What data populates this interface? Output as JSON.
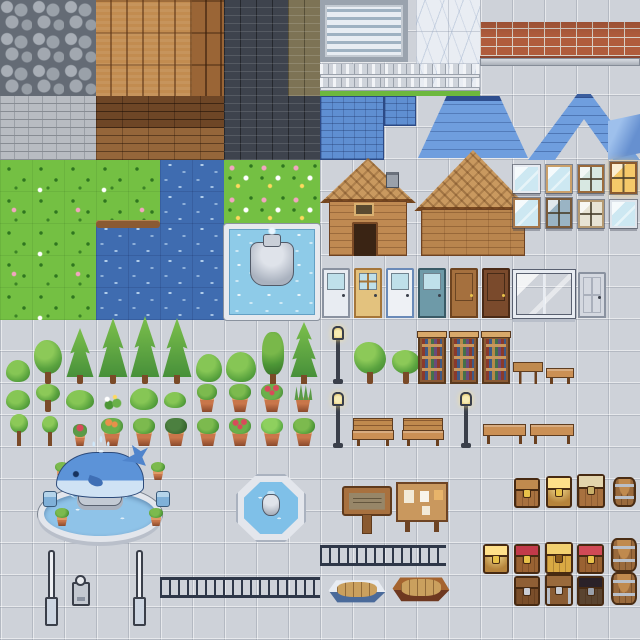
{
  "sheet": {
    "description": "pixel-art town tileset sprite sheet",
    "tile_size_px": 32,
    "grid": "20x20 tiles",
    "canvas": "640x640"
  },
  "palette": {
    "floor_tile": "#ced2d9",
    "grass": "#74c043",
    "water": "#3f6cb0",
    "pool_water": "#8ecbe8",
    "roof_blue": "#5f8fd2",
    "wood_plank": "#c28c50",
    "brick_red": "#b05c3c",
    "brick_dark": "#3e434d",
    "stone_brick": "#b8bcc2",
    "marble": "#e9edf3",
    "whale_blue": "#5c93d8",
    "chest_gold": "#e8c24a",
    "terracotta": "#c9764a",
    "barrel_wood": "#9a6a3c"
  },
  "sections": {
    "top_left": "cobblestone, wood plank floors, brick walls, stone walls, grass, river and lake water, swimming pool with fountain",
    "top_right": "blinds window, marble wall, red brick ledge, picket fence, blue roofs, wooden cabins, windows, doors",
    "middle": "trees, bushes, potted plants, lamp posts, bookshelves, benches, tables",
    "bottom": "whale fountain, octagon fountain, wooden sign, notice board, railings, boats, treasure chests, barrels, posts"
  },
  "sprites": [
    {
      "name": "cobblestone-floor",
      "kind": "cobble",
      "x": 0,
      "y": 0,
      "w": 96,
      "h": 96
    },
    {
      "name": "wood-plank-floor-light",
      "kind": "wood-v",
      "x": 96,
      "y": 0,
      "w": 96,
      "h": 96
    },
    {
      "name": "wood-plank-floor-dark",
      "kind": "wood-v-dark",
      "x": 192,
      "y": 0,
      "w": 32,
      "h": 96
    },
    {
      "name": "brick-wall-dark",
      "kind": "brick-dark",
      "x": 224,
      "y": 0,
      "w": 64,
      "h": 160
    },
    {
      "name": "brick-wall-olive",
      "kind": "brick-olive",
      "x": 288,
      "y": 0,
      "w": 32,
      "h": 96
    },
    {
      "name": "brick-wall-dark-2",
      "kind": "brick-dark",
      "x": 288,
      "y": 96,
      "w": 32,
      "h": 64
    },
    {
      "name": "stone-brick-wall",
      "kind": "brick-gray",
      "x": 0,
      "y": 96,
      "w": 96,
      "h": 64
    },
    {
      "name": "wood-planks-horizontal-dark",
      "kind": "wood-h-dark",
      "x": 96,
      "y": 96,
      "w": 128,
      "h": 32
    },
    {
      "name": "wood-planks-horizontal",
      "kind": "wood-h",
      "x": 96,
      "y": 128,
      "w": 128,
      "h": 32
    },
    {
      "name": "grass-field",
      "kind": "grass",
      "x": 0,
      "y": 160,
      "w": 160,
      "h": 64
    },
    {
      "name": "river-water",
      "kind": "water",
      "x": 160,
      "y": 160,
      "w": 64,
      "h": 64
    },
    {
      "name": "grass-flower-field",
      "kind": "grass-flowers",
      "x": 224,
      "y": 160,
      "w": 96,
      "h": 64
    },
    {
      "name": "grass-field-2",
      "kind": "grass",
      "x": 0,
      "y": 224,
      "w": 96,
      "h": 96
    },
    {
      "name": "lake-water",
      "kind": "water",
      "x": 96,
      "y": 224,
      "w": 128,
      "h": 96
    },
    {
      "name": "shore-edge",
      "kind": "shore",
      "x": 96,
      "y": 220,
      "w": 64,
      "h": 8
    },
    {
      "name": "swimming-pool",
      "kind": "pool",
      "x": 224,
      "y": 224,
      "w": 96,
      "h": 96
    },
    {
      "name": "pool-fountain",
      "kind": "pool-fountain",
      "x": 250,
      "y": 242,
      "w": 44,
      "h": 44
    },
    {
      "name": "window-blinds",
      "kind": "blinds",
      "x": 320,
      "y": 0,
      "w": 88,
      "h": 62
    },
    {
      "name": "marble-wall",
      "kind": "marble",
      "x": 416,
      "y": 0,
      "w": 64,
      "h": 96
    },
    {
      "name": "red-brick-ledge",
      "kind": "brick-red",
      "x": 480,
      "y": 22,
      "w": 160,
      "h": 36
    },
    {
      "name": "stone-ledge",
      "kind": "ledge",
      "x": 480,
      "y": 58,
      "w": 160,
      "h": 8
    },
    {
      "name": "picket-fence",
      "kind": "fence",
      "x": 320,
      "y": 64,
      "w": 160,
      "h": 32
    },
    {
      "name": "blue-roof-flat",
      "kind": "roof-flat",
      "x": 320,
      "y": 96,
      "w": 64,
      "h": 64
    },
    {
      "name": "blue-roof-tile",
      "kind": "roof-flat",
      "x": 384,
      "y": 96,
      "w": 32,
      "h": 30
    },
    {
      "name": "blue-roof-hip",
      "kind": "roof-hip",
      "x": 418,
      "y": 96,
      "w": 110,
      "h": 62
    },
    {
      "name": "blue-roof-gable",
      "kind": "roof-chevron",
      "x": 528,
      "y": 94,
      "w": 112,
      "h": 66
    },
    {
      "name": "blue-glass-corner",
      "kind": "glass-corner",
      "x": 608,
      "y": 114,
      "w": 32,
      "h": 46
    },
    {
      "name": "cabin-house",
      "kind": "house-a",
      "x": 320,
      "y": 158,
      "w": 96,
      "h": 98
    },
    {
      "name": "barn-house",
      "kind": "house-b",
      "x": 414,
      "y": 150,
      "w": 118,
      "h": 106
    },
    {
      "name": "cabin-chimney",
      "kind": "chimney",
      "x": 386,
      "y": 172,
      "w": 13,
      "h": 16
    },
    {
      "name": "cabin-window",
      "kind": "window-small",
      "x": 354,
      "y": 203,
      "w": 20,
      "h": 13
    },
    {
      "name": "cabin-doorway",
      "kind": "doorway",
      "x": 352,
      "y": 222,
      "w": 26,
      "h": 34
    },
    {
      "name": "window-white",
      "kind": "win win-white",
      "x": 513,
      "y": 165,
      "w": 27,
      "h": 28
    },
    {
      "name": "window-glass",
      "kind": "win win-glass",
      "x": 546,
      "y": 165,
      "w": 26,
      "h": 28
    },
    {
      "name": "window-brown-4pane",
      "kind": "win cross win-brown",
      "x": 578,
      "y": 165,
      "w": 26,
      "h": 28
    },
    {
      "name": "window-lit",
      "kind": "win cross win-lit",
      "x": 610,
      "y": 162,
      "w": 27,
      "h": 32
    },
    {
      "name": "window-wood-2pane",
      "kind": "win win-wood2",
      "x": 513,
      "y": 198,
      "w": 27,
      "h": 30
    },
    {
      "name": "window-dark-4pane",
      "kind": "win cross win-dark4",
      "x": 546,
      "y": 198,
      "w": 26,
      "h": 30
    },
    {
      "name": "window-cream",
      "kind": "win cross win-cream",
      "x": 578,
      "y": 200,
      "w": 26,
      "h": 28
    },
    {
      "name": "window-white-2",
      "kind": "win win-white2",
      "x": 610,
      "y": 200,
      "w": 27,
      "h": 28
    },
    {
      "name": "door-white-glass",
      "kind": "door door-whiteglass",
      "x": 322,
      "y": 268,
      "w": 28,
      "h": 50
    },
    {
      "name": "door-tan",
      "kind": "door door-tan",
      "x": 354,
      "y": 268,
      "w": 28,
      "h": 50
    },
    {
      "name": "door-white-blue",
      "kind": "door door-whiteblue",
      "x": 386,
      "y": 268,
      "w": 28,
      "h": 50
    },
    {
      "name": "door-teal-glass",
      "kind": "door door-teal",
      "x": 418,
      "y": 268,
      "w": 28,
      "h": 50
    },
    {
      "name": "door-brown",
      "kind": "door door-brown",
      "x": 450,
      "y": 268,
      "w": 28,
      "h": 50
    },
    {
      "name": "door-dark-brown",
      "kind": "door door-dark",
      "x": 482,
      "y": 268,
      "w": 28,
      "h": 50
    },
    {
      "name": "storefront-window",
      "kind": "big-window",
      "x": 513,
      "y": 270,
      "w": 62,
      "h": 48
    },
    {
      "name": "door-gray-panel",
      "kind": "door door-gray",
      "x": 578,
      "y": 272,
      "w": 28,
      "h": 46
    },
    {
      "name": "bush-small",
      "kind": "bush",
      "x": 6,
      "y": 360,
      "w": 24,
      "h": 22
    },
    {
      "name": "tree-round-medium",
      "kind": "tree-round",
      "x": 34,
      "y": 340,
      "w": 28,
      "h": 44
    },
    {
      "name": "tree-conifer",
      "kind": "tree-conifer",
      "x": 66,
      "y": 328,
      "w": 28,
      "h": 56
    },
    {
      "name": "tree-conifer-tall-1",
      "kind": "tree-conifer",
      "x": 98,
      "y": 318,
      "w": 30,
      "h": 66
    },
    {
      "name": "tree-conifer-tall-2",
      "kind": "tree-conifer",
      "x": 130,
      "y": 316,
      "w": 30,
      "h": 68
    },
    {
      "name": "tree-conifer-tall-3",
      "kind": "tree-conifer",
      "x": 162,
      "y": 318,
      "w": 30,
      "h": 66
    },
    {
      "name": "bush-medium",
      "kind": "bush",
      "x": 196,
      "y": 354,
      "w": 26,
      "h": 28
    },
    {
      "name": "bush-wide",
      "kind": "bush",
      "x": 226,
      "y": 352,
      "w": 30,
      "h": 30
    },
    {
      "name": "tree-slim",
      "kind": "tree-slim",
      "x": 260,
      "y": 332,
      "w": 26,
      "h": 52
    },
    {
      "name": "tree-pine-double",
      "kind": "tree-pine2",
      "x": 290,
      "y": 322,
      "w": 28,
      "h": 62
    },
    {
      "name": "lamp-post-1",
      "kind": "lamp",
      "x": 331,
      "y": 326,
      "w": 14,
      "h": 58
    },
    {
      "name": "tree-round-leafy-1",
      "kind": "tree-round",
      "x": 354,
      "y": 342,
      "w": 32,
      "h": 42
    },
    {
      "name": "tree-round-leafy-2",
      "kind": "tree-round",
      "x": 392,
      "y": 350,
      "w": 28,
      "h": 34
    },
    {
      "name": "bookshelf-1",
      "kind": "bookshelf",
      "x": 418,
      "y": 334,
      "w": 28,
      "h": 50
    },
    {
      "name": "bookshelf-2",
      "kind": "bookshelf",
      "x": 450,
      "y": 334,
      "w": 28,
      "h": 50
    },
    {
      "name": "bookshelf-3",
      "kind": "bookshelf",
      "x": 482,
      "y": 334,
      "w": 28,
      "h": 50
    },
    {
      "name": "table",
      "kind": "table",
      "x": 513,
      "y": 362,
      "w": 30,
      "h": 22
    },
    {
      "name": "bench-low",
      "kind": "bench-backless",
      "x": 546,
      "y": 368,
      "w": 28,
      "h": 16
    },
    {
      "name": "bush-dome-1",
      "kind": "bush",
      "x": 6,
      "y": 390,
      "w": 24,
      "h": 20
    },
    {
      "name": "tree-round-small",
      "kind": "tree-round",
      "x": 36,
      "y": 384,
      "w": 24,
      "h": 28
    },
    {
      "name": "bush-wide-2",
      "kind": "bush",
      "x": 66,
      "y": 390,
      "w": 28,
      "h": 20
    },
    {
      "name": "flower-sprigs",
      "kind": "flowers",
      "x": 100,
      "y": 392,
      "w": 24,
      "h": 18
    },
    {
      "name": "bush-dense",
      "kind": "bush",
      "x": 130,
      "y": 388,
      "w": 28,
      "h": 22
    },
    {
      "name": "bush-dome-2",
      "kind": "bush",
      "x": 164,
      "y": 392,
      "w": 22,
      "h": 16
    },
    {
      "name": "potted-plant-1",
      "kind": "pot pot-leafy",
      "x": 196,
      "y": 384,
      "w": 22,
      "h": 28
    },
    {
      "name": "potted-plant-2",
      "kind": "pot pot-leafy",
      "x": 228,
      "y": 384,
      "w": 24,
      "h": 28
    },
    {
      "name": "potted-plant-red",
      "kind": "pot pot-red",
      "x": 260,
      "y": 384,
      "w": 24,
      "h": 28
    },
    {
      "name": "potted-plant-spiky",
      "kind": "pot pot-spiky",
      "x": 292,
      "y": 384,
      "w": 22,
      "h": 28
    },
    {
      "name": "tree-lollipop-1",
      "kind": "tree-lollipop",
      "x": 8,
      "y": 414,
      "w": 22,
      "h": 32
    },
    {
      "name": "tree-lollipop-2",
      "kind": "tree-lollipop",
      "x": 40,
      "y": 416,
      "w": 20,
      "h": 30
    },
    {
      "name": "potted-flower-small",
      "kind": "pot pot-redsm",
      "x": 72,
      "y": 424,
      "w": 16,
      "h": 22
    },
    {
      "name": "potted-plant-3",
      "kind": "pot pot-orange",
      "x": 100,
      "y": 418,
      "w": 24,
      "h": 28
    },
    {
      "name": "potted-plant-4",
      "kind": "pot pot-leafy",
      "x": 132,
      "y": 418,
      "w": 24,
      "h": 28
    },
    {
      "name": "potted-plant-5",
      "kind": "pot pot-dark",
      "x": 164,
      "y": 418,
      "w": 24,
      "h": 28
    },
    {
      "name": "potted-plant-6",
      "kind": "pot pot-leafy",
      "x": 196,
      "y": 418,
      "w": 24,
      "h": 28
    },
    {
      "name": "potted-plant-red-2",
      "kind": "pot pot-red",
      "x": 228,
      "y": 418,
      "w": 24,
      "h": 28
    },
    {
      "name": "potted-plant-7",
      "kind": "pot pot-green",
      "x": 260,
      "y": 418,
      "w": 24,
      "h": 28
    },
    {
      "name": "potted-plant-8",
      "kind": "pot pot-leafy",
      "x": 292,
      "y": 418,
      "w": 24,
      "h": 28
    },
    {
      "name": "lamp-post-2",
      "kind": "lamp",
      "x": 331,
      "y": 392,
      "w": 14,
      "h": 56
    },
    {
      "name": "bench-1",
      "kind": "bench",
      "x": 352,
      "y": 418,
      "w": 42,
      "h": 28
    },
    {
      "name": "bench-2",
      "kind": "bench",
      "x": 402,
      "y": 418,
      "w": 42,
      "h": 28
    },
    {
      "name": "lamp-post-3",
      "kind": "lamp",
      "x": 459,
      "y": 392,
      "w": 14,
      "h": 56
    },
    {
      "name": "bench-backless-1",
      "kind": "bench-backless",
      "x": 483,
      "y": 424,
      "w": 43,
      "h": 20
    },
    {
      "name": "bench-backless-2",
      "kind": "bench-backless",
      "x": 530,
      "y": 424,
      "w": 44,
      "h": 20
    },
    {
      "name": "whale-fountain-basin",
      "kind": "wf-basin",
      "x": 38,
      "y": 486,
      "w": 124,
      "h": 56
    },
    {
      "name": "whale-fountain-pedestal",
      "kind": "wf-pedestal",
      "x": 78,
      "y": 478,
      "w": 44,
      "h": 28
    },
    {
      "name": "fountain-jet-left",
      "kind": "jet jet-l",
      "x": 64,
      "y": 468,
      "w": 20,
      "h": 30
    },
    {
      "name": "fountain-jet-right",
      "kind": "jet jet-r",
      "x": 116,
      "y": 468,
      "w": 20,
      "h": 30
    },
    {
      "name": "whale-statue",
      "kind": "whale",
      "x": 56,
      "y": 452,
      "w": 88,
      "h": 46
    },
    {
      "name": "whale-spout",
      "kind": "spout",
      "x": 88,
      "y": 436,
      "w": 26,
      "h": 18
    },
    {
      "name": "fountain-pot-1",
      "kind": "pot pot-leafy",
      "x": 54,
      "y": 462,
      "w": 16,
      "h": 18
    },
    {
      "name": "fountain-pot-2",
      "kind": "pot pot-leafy",
      "x": 150,
      "y": 462,
      "w": 16,
      "h": 18
    },
    {
      "name": "fountain-pot-3",
      "kind": "pot pot-leafy",
      "x": 54,
      "y": 508,
      "w": 16,
      "h": 18
    },
    {
      "name": "fountain-pot-4",
      "kind": "pot pot-leafy",
      "x": 148,
      "y": 508,
      "w": 16,
      "h": 18
    },
    {
      "name": "fountain-seat-1",
      "kind": "blue-seat",
      "x": 43,
      "y": 491,
      "w": 14,
      "h": 16
    },
    {
      "name": "fountain-seat-2",
      "kind": "blue-seat",
      "x": 156,
      "y": 491,
      "w": 14,
      "h": 16
    },
    {
      "name": "octagon-fountain",
      "kind": "oct-fountain",
      "x": 236,
      "y": 474,
      "w": 70,
      "h": 68
    },
    {
      "name": "wooden-sign",
      "kind": "sign",
      "x": 342,
      "y": 486,
      "w": 50,
      "h": 48
    },
    {
      "name": "notice-board",
      "kind": "board",
      "x": 396,
      "y": 482,
      "w": 52,
      "h": 50
    },
    {
      "name": "chest-wood",
      "kind": "chest c-wood",
      "x": 514,
      "y": 478,
      "w": 26,
      "h": 30
    },
    {
      "name": "chest-gold-front",
      "kind": "chest c-goldlit",
      "x": 546,
      "y": 476,
      "w": 26,
      "h": 32
    },
    {
      "name": "chest-open-tan",
      "kind": "chest c-opentan",
      "x": 577,
      "y": 474,
      "w": 28,
      "h": 34
    },
    {
      "name": "barrel-small",
      "kind": "barrel",
      "x": 613,
      "y": 477,
      "w": 23,
      "h": 30
    },
    {
      "name": "chest-gold-open",
      "kind": "chest c-goldlit",
      "x": 483,
      "y": 544,
      "w": 26,
      "h": 30
    },
    {
      "name": "chest-red-lid",
      "kind": "chest c-red",
      "x": 514,
      "y": 544,
      "w": 26,
      "h": 30
    },
    {
      "name": "chest-gold",
      "kind": "chest c-gold",
      "x": 545,
      "y": 542,
      "w": 28,
      "h": 32
    },
    {
      "name": "chest-red-open",
      "kind": "chest c-redopen",
      "x": 577,
      "y": 544,
      "w": 27,
      "h": 30
    },
    {
      "name": "barrel-1",
      "kind": "barrel",
      "x": 611,
      "y": 538,
      "w": 26,
      "h": 34
    },
    {
      "name": "chest-dark-wood",
      "kind": "chest c-darkwood",
      "x": 514,
      "y": 576,
      "w": 26,
      "h": 30
    },
    {
      "name": "chest-metal",
      "kind": "chest c-metal",
      "x": 545,
      "y": 574,
      "w": 28,
      "h": 32
    },
    {
      "name": "chest-black-open",
      "kind": "chest c-blackopen",
      "x": 577,
      "y": 576,
      "w": 27,
      "h": 30
    },
    {
      "name": "barrel-2",
      "kind": "barrel",
      "x": 611,
      "y": 572,
      "w": 26,
      "h": 33
    },
    {
      "name": "post-1",
      "kind": "pole",
      "x": 44,
      "y": 550,
      "w": 13,
      "h": 76
    },
    {
      "name": "post-2",
      "kind": "pole",
      "x": 132,
      "y": 550,
      "w": 13,
      "h": 76
    },
    {
      "name": "parking-meter",
      "kind": "meter",
      "x": 72,
      "y": 582,
      "w": 18,
      "h": 24
    },
    {
      "name": "railing-long-1",
      "kind": "railing",
      "x": 320,
      "y": 545,
      "w": 126,
      "h": 21
    },
    {
      "name": "railing-long-2",
      "kind": "railing",
      "x": 160,
      "y": 577,
      "w": 160,
      "h": 21
    },
    {
      "name": "boat-white",
      "kind": "boat boat-white",
      "x": 328,
      "y": 577,
      "w": 58,
      "h": 27
    },
    {
      "name": "boat-brown",
      "kind": "boat boat-brown",
      "x": 392,
      "y": 574,
      "w": 58,
      "h": 29
    }
  ]
}
